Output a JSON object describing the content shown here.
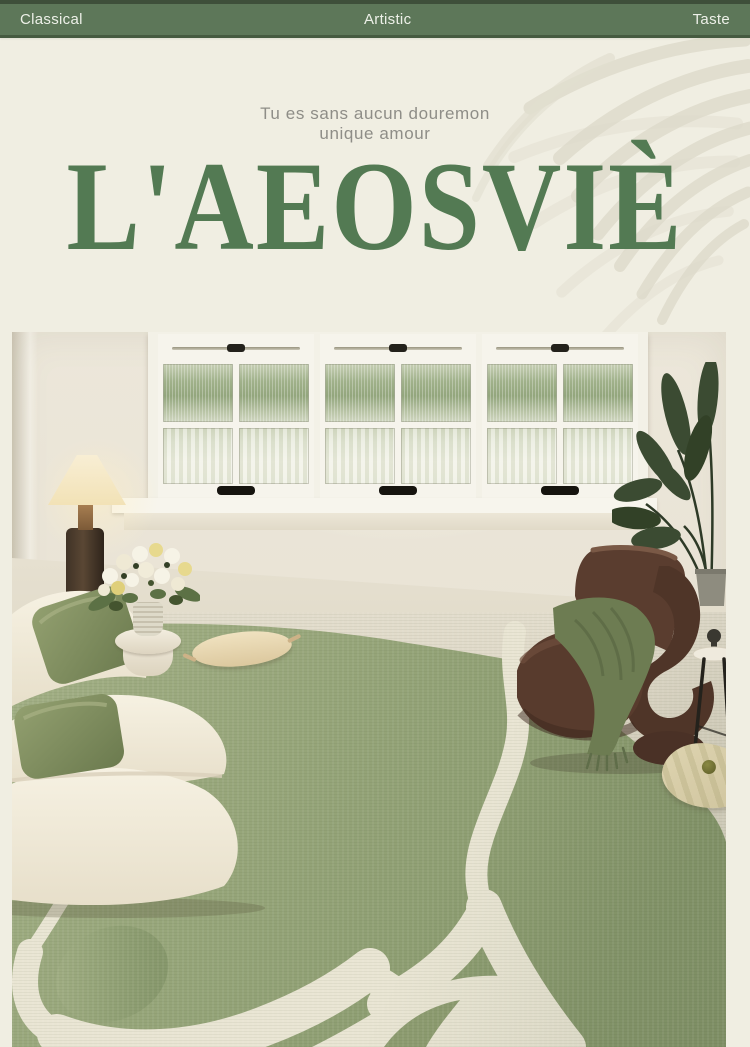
{
  "topbar": {
    "background": "#5d7759",
    "items": [
      {
        "label": "Classical"
      },
      {
        "label": "Artistic"
      },
      {
        "label": "Taste"
      }
    ]
  },
  "hero": {
    "background": "#f0eee2",
    "tagline_line1": "Tu es sans aucun douremon",
    "tagline_line2": "unique amour",
    "tagline_color": "#8e8d87",
    "brand": "L'AEOSVIÈ",
    "brand_color": "#537a53",
    "decoration": "palm-frond-shadow"
  },
  "photo": {
    "scene": "living room with abstract sage-green area rug",
    "objects": [
      "casement-windows-garden-view",
      "floor-lamp",
      "white-side-table",
      "flower-bouquet-vase",
      "curved-cream-sofa",
      "sage-green-cushions",
      "tasseled-lumbar-cushion",
      "abstract-pattern-rug",
      "brown-sculptural-lounge-chair",
      "green-throw-blanket",
      "potted-plant",
      "black-wire-side-stool",
      "patterned-floor-pillow"
    ],
    "palette": {
      "wall": "#e9e4d6",
      "floor": "#ddd7c5",
      "rug_green": "#98a77c",
      "rug_pattern_cream": "#e9e5d3",
      "sofa_cream": "#f3eedf",
      "cushion_green": "#7d8a5f",
      "chair_brown": "#57392c",
      "blanket_green": "#6d7c52",
      "plant_green": "#3c4c33",
      "lamp_shade": "#f5e9c9",
      "window_frame": "#f5f3ea"
    }
  }
}
